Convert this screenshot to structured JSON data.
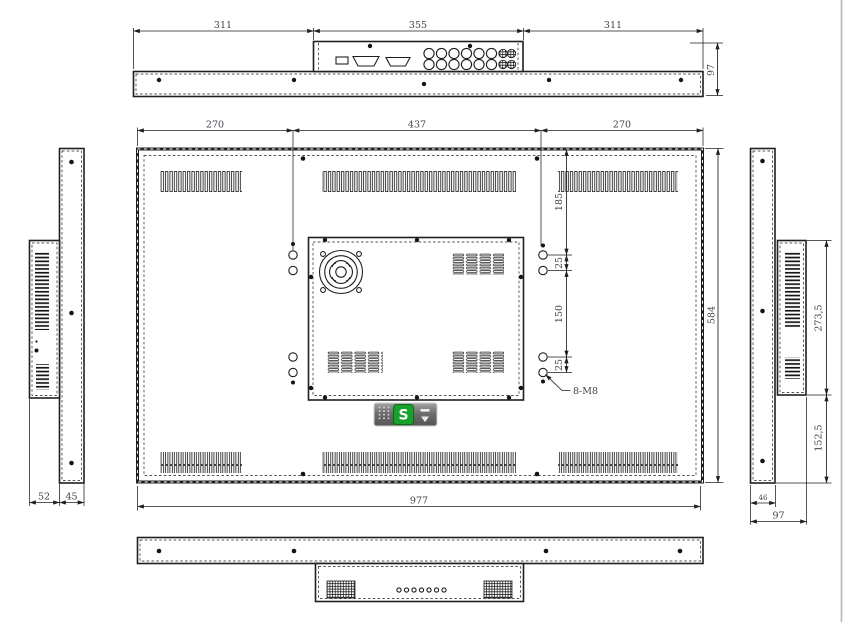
{
  "meta": {
    "drawing_kind": "monitor rear/side/top orthographic technical drawing",
    "line_color": "#1f1f1f",
    "text_color": "#41414b",
    "background": "#ffffff",
    "page_edge_color": "#b5b5b5"
  },
  "top_view": {
    "dim_left": "311",
    "dim_center": "355",
    "dim_right": "311",
    "dim_depth": "97"
  },
  "rear_view": {
    "dim_top_left": "270",
    "dim_top_center": "437",
    "dim_top_right": "270",
    "dim_height": "584",
    "dim_width": "977",
    "dim_vesa_top_offset": "185",
    "dim_vesa_pair_top": "25",
    "dim_vesa_span": "150",
    "dim_vesa_pair_bottom": "25",
    "vesa_thread_label": "8-M8"
  },
  "left_view": {
    "dim_protrusion_depth": "52",
    "dim_body_depth": "45"
  },
  "right_view": {
    "dim_upper_height": "273,5",
    "dim_lower_height": "152,5",
    "dim_body_depth": "46",
    "dim_total_depth": "97"
  },
  "watermark": {
    "letter": "S",
    "green": "#18a12c"
  }
}
